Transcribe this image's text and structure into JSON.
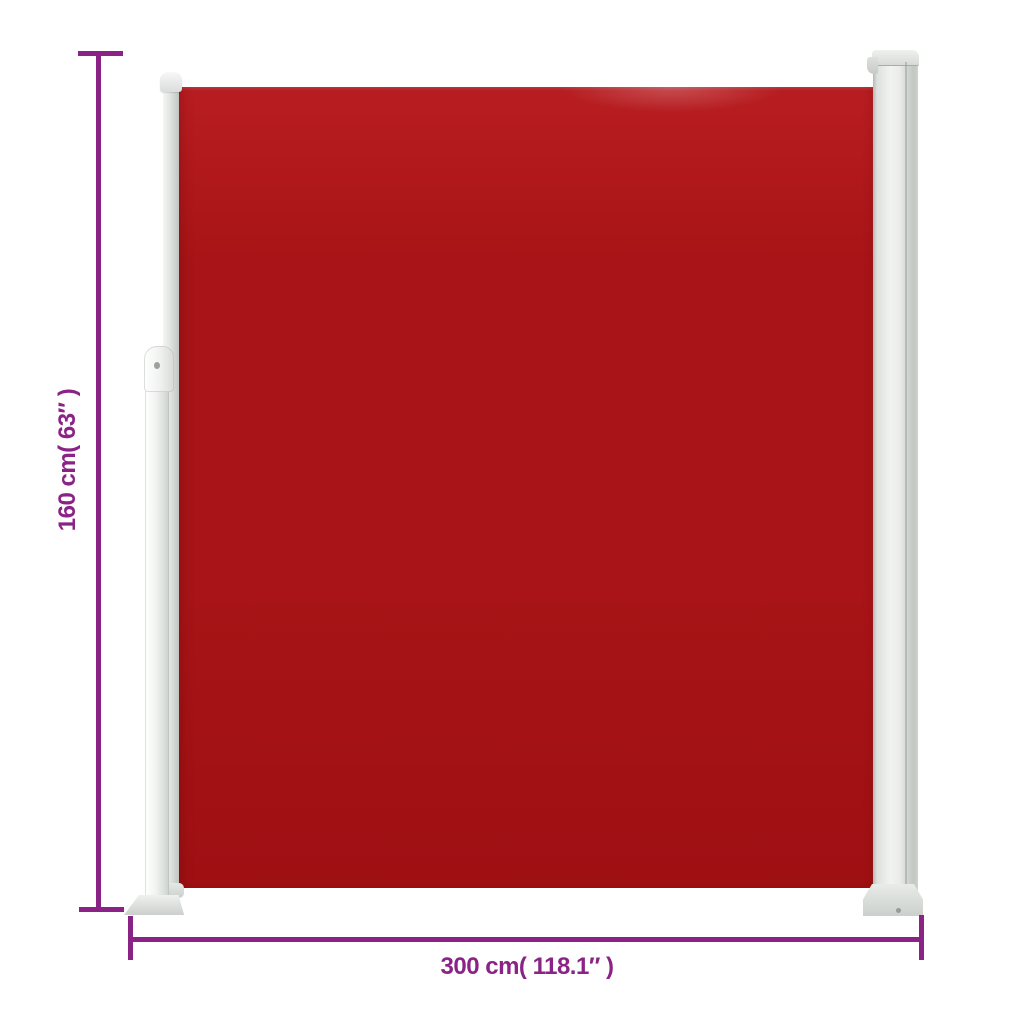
{
  "dimensions": {
    "height_label": "160 cm( 63″ )",
    "width_label": "300 cm( 118.1″ )"
  },
  "colors": {
    "bg": "#FFFFFF",
    "dim": "#8B2386",
    "fabric-top": "#B81D21",
    "fabric-mid": "#A81417",
    "fabric-bottom": "#9F1013",
    "metal-light": "#F1F3F1",
    "metal-mid": "#E3E6E3",
    "metal-dark": "#9BA19C"
  }
}
